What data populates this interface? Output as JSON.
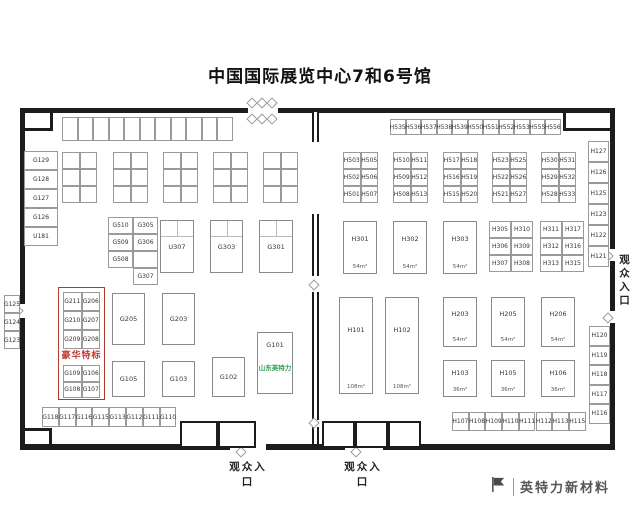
{
  "title": "中国国际展览中心7和6号馆",
  "entrances": {
    "bottom_left": "观众入口",
    "bottom_right": "观众入口",
    "right_side": "观众入口"
  },
  "watermark": {
    "brand": "英特力新材料"
  },
  "colors": {
    "wall": "#1c1c1c",
    "booth_border": "#9a9a9a",
    "accent_red": "#c0392b",
    "accent_green": "#2e9e4f"
  },
  "plan": {
    "walls": [
      [
        20,
        108,
        228,
        5
      ],
      [
        278,
        108,
        337,
        5
      ],
      [
        50,
        113,
        3,
        17
      ],
      [
        20,
        128,
        33,
        3
      ],
      [
        563,
        113,
        3,
        17
      ],
      [
        563,
        128,
        52,
        3
      ],
      [
        20,
        108,
        5,
        196
      ],
      [
        20,
        318,
        5,
        131
      ],
      [
        25,
        428,
        26,
        3
      ],
      [
        49,
        428,
        3,
        18
      ],
      [
        610,
        108,
        5,
        141
      ],
      [
        610,
        261,
        5,
        50
      ],
      [
        610,
        323,
        5,
        126
      ],
      [
        20,
        444,
        210,
        6
      ],
      [
        266,
        444,
        79,
        6
      ],
      [
        383,
        444,
        232,
        6
      ]
    ],
    "wall2": [
      [
        312,
        112,
        7,
        30
      ],
      [
        312,
        214,
        7,
        62
      ],
      [
        312,
        292,
        7,
        128
      ],
      [
        312,
        427,
        7,
        17
      ]
    ],
    "doors": [
      [
        248,
        99
      ],
      [
        258,
        99
      ],
      [
        268,
        99
      ],
      [
        248,
        115
      ],
      [
        258,
        115
      ],
      [
        268,
        115
      ],
      [
        14,
        307
      ],
      [
        604,
        252
      ],
      [
        604,
        314
      ],
      [
        310,
        281
      ],
      [
        310,
        419
      ],
      [
        237,
        448
      ],
      [
        352,
        448
      ]
    ],
    "bottom_rooms": [
      {
        "x": 180,
        "y": 421,
        "w": 76,
        "h": 27,
        "cells": 2
      },
      {
        "x": 322,
        "y": 421,
        "w": 99,
        "h": 27,
        "cells": 3
      }
    ],
    "strips": [
      {
        "name": "g-top-strip",
        "x": 62,
        "y": 117,
        "dir": "h",
        "cellW": 15.5,
        "cellH": 24,
        "labels": [
          "",
          "",
          "",
          "",
          "",
          "",
          "",
          "",
          "",
          "",
          ""
        ]
      },
      {
        "name": "h-top-strip",
        "x": 390,
        "y": 119,
        "dir": "h",
        "cellW": 15.5,
        "cellH": 16,
        "labels": [
          "H535",
          "H536",
          "H537",
          "H538",
          "H539",
          "H550",
          "H551",
          "H552",
          "H553",
          "H555",
          "H556"
        ]
      },
      {
        "name": "g-bottom-strip",
        "x": 42,
        "y": 407,
        "dir": "h",
        "cellW": 16.8,
        "cellH": 20,
        "labels": [
          "G118",
          "G117",
          "G116",
          "G115",
          "G113",
          "G112",
          "G111",
          "G110"
        ]
      },
      {
        "name": "h-bottom-strip",
        "x": 452,
        "y": 412,
        "dir": "h",
        "cellW": 16.7,
        "cellH": 19,
        "labels": [
          "H107",
          "H108",
          "H109",
          "H110",
          "H111",
          "H112",
          "H113",
          "H115"
        ]
      },
      {
        "name": "left-col-top",
        "x": 24,
        "y": 151,
        "dir": "v",
        "cellW": 34,
        "cellH": 19,
        "labels": [
          "G129",
          "G128",
          "G127",
          "G126",
          "U181"
        ]
      },
      {
        "name": "left-col-mid",
        "x": 4,
        "y": 295,
        "dir": "v",
        "cellW": 16,
        "cellH": 18,
        "labels": [
          "G125",
          "G124",
          "G123"
        ]
      },
      {
        "name": "right-col-top",
        "x": 588,
        "y": 141,
        "dir": "v",
        "cellW": 21,
        "cellH": 21,
        "labels": [
          "H127",
          "H126",
          "H125",
          "H123",
          "H122",
          "H121"
        ]
      },
      {
        "name": "right-col-bottom",
        "x": 589,
        "y": 326,
        "dir": "v",
        "cellW": 21,
        "cellH": 19.5,
        "labels": [
          "H120",
          "H119",
          "H118",
          "H117",
          "H116"
        ]
      }
    ],
    "grids": [
      {
        "name": "g-empty-1",
        "x": 62,
        "y": 152,
        "cellW": 17.5,
        "cellH": 17,
        "rows": [
          [
            "",
            ""
          ],
          [
            "",
            ""
          ],
          [
            "",
            ""
          ]
        ]
      },
      {
        "name": "g-empty-2",
        "x": 113,
        "y": 152,
        "cellW": 17.5,
        "cellH": 17,
        "rows": [
          [
            "",
            ""
          ],
          [
            "",
            ""
          ],
          [
            "",
            ""
          ]
        ]
      },
      {
        "name": "g-empty-3",
        "x": 163,
        "y": 152,
        "cellW": 17.5,
        "cellH": 17,
        "rows": [
          [
            "",
            ""
          ],
          [
            "",
            ""
          ],
          [
            "",
            ""
          ]
        ]
      },
      {
        "name": "g-empty-4",
        "x": 213,
        "y": 152,
        "cellW": 17.5,
        "cellH": 17,
        "rows": [
          [
            "",
            ""
          ],
          [
            "",
            ""
          ],
          [
            "",
            ""
          ]
        ]
      },
      {
        "name": "g-empty-5",
        "x": 263,
        "y": 152,
        "cellW": 17.5,
        "cellH": 17,
        "rows": [
          [
            "",
            ""
          ],
          [
            "",
            ""
          ],
          [
            "",
            ""
          ]
        ]
      },
      {
        "name": "g510-block",
        "x": 108,
        "y": 217,
        "cellW": 25,
        "cellH": 17,
        "rows": [
          [
            "G510",
            "G305"
          ],
          [
            "G509",
            "G306"
          ],
          [
            "G508",
            ""
          ],
          [
            null,
            "G307"
          ]
        ]
      },
      {
        "name": "red-grid-1",
        "x": 63,
        "y": 292,
        "cellW": 18.5,
        "cellH": 19,
        "rows": [
          [
            "G211",
            "G206"
          ],
          [
            "G210",
            "G207"
          ],
          [
            "G209",
            "G208"
          ]
        ]
      },
      {
        "name": "red-grid-2",
        "x": 63,
        "y": 365,
        "cellW": 18.5,
        "cellH": 16.5,
        "rows": [
          [
            "G109",
            "G106"
          ],
          [
            "G108",
            "G107"
          ]
        ]
      },
      {
        "name": "h503-block",
        "x": 343,
        "y": 152,
        "cellW": 17.5,
        "cellH": 17,
        "rows": [
          [
            "H503",
            "H505"
          ],
          [
            "H502",
            "H506"
          ],
          [
            "H501",
            "H507"
          ]
        ]
      },
      {
        "name": "h510-block",
        "x": 393,
        "y": 152,
        "cellW": 17.5,
        "cellH": 17,
        "rows": [
          [
            "H510",
            "H511"
          ],
          [
            "H509",
            "H512"
          ],
          [
            "H508",
            "H513"
          ]
        ]
      },
      {
        "name": "h517-block",
        "x": 443,
        "y": 152,
        "cellW": 17.5,
        "cellH": 17,
        "rows": [
          [
            "H517",
            "H518"
          ],
          [
            "H516",
            "H519"
          ],
          [
            "H515",
            "H520"
          ]
        ]
      },
      {
        "name": "h523-block",
        "x": 492,
        "y": 152,
        "cellW": 17.5,
        "cellH": 17,
        "rows": [
          [
            "H523",
            "H525"
          ],
          [
            "H522",
            "H526"
          ],
          [
            "H521",
            "H527"
          ]
        ]
      },
      {
        "name": "h530-block",
        "x": 541,
        "y": 152,
        "cellW": 17.5,
        "cellH": 17,
        "rows": [
          [
            "H530",
            "H531"
          ],
          [
            "H529",
            "H532"
          ],
          [
            "H528",
            "H533"
          ]
        ]
      },
      {
        "name": "h305-block",
        "x": 489,
        "y": 221,
        "cellW": 22,
        "cellH": 17,
        "rows": [
          [
            "H305",
            "H310"
          ],
          [
            "H306",
            "H309"
          ],
          [
            "H307",
            "H308"
          ]
        ]
      },
      {
        "name": "h311-block",
        "x": 540,
        "y": 221,
        "cellW": 22,
        "cellH": 17,
        "rows": [
          [
            "H311",
            "H317"
          ],
          [
            "H312",
            "H316"
          ],
          [
            "H313",
            "H315"
          ]
        ]
      }
    ],
    "rooms": [
      {
        "label": "U307",
        "x": 160,
        "y": 220,
        "w": 34,
        "h": 53,
        "div": true
      },
      {
        "label": "G303",
        "x": 210,
        "y": 220,
        "w": 33,
        "h": 53,
        "div": true
      },
      {
        "label": "G301",
        "x": 259,
        "y": 220,
        "w": 34,
        "h": 53,
        "div": true
      },
      {
        "label": "G205",
        "x": 112,
        "y": 293,
        "w": 33,
        "h": 52
      },
      {
        "label": "G203",
        "x": 162,
        "y": 293,
        "w": 33,
        "h": 52
      },
      {
        "label": "G105",
        "x": 112,
        "y": 361,
        "w": 33,
        "h": 36
      },
      {
        "label": "G103",
        "x": 162,
        "y": 361,
        "w": 33,
        "h": 36
      },
      {
        "label": "G102",
        "x": 212,
        "y": 357,
        "w": 33,
        "h": 40
      },
      {
        "label": "G101",
        "x": 257,
        "y": 332,
        "w": 36,
        "h": 62,
        "sublabel": "山东英特力",
        "labelPos": "top"
      },
      {
        "label": "H301",
        "x": 343,
        "y": 221,
        "w": 34,
        "h": 53,
        "size": "54m²"
      },
      {
        "label": "H302",
        "x": 393,
        "y": 221,
        "w": 34,
        "h": 53,
        "size": "54m²"
      },
      {
        "label": "H303",
        "x": 443,
        "y": 221,
        "w": 34,
        "h": 53,
        "size": "54m²"
      },
      {
        "label": "H101",
        "x": 339,
        "y": 297,
        "w": 34,
        "h": 97,
        "size": "108m²"
      },
      {
        "label": "H102",
        "x": 385,
        "y": 297,
        "w": 34,
        "h": 97,
        "size": "108m²"
      },
      {
        "label": "H203",
        "x": 443,
        "y": 297,
        "w": 34,
        "h": 50,
        "size": "54m²"
      },
      {
        "label": "H205",
        "x": 491,
        "y": 297,
        "w": 34,
        "h": 50,
        "size": "54m²"
      },
      {
        "label": "H206",
        "x": 541,
        "y": 297,
        "w": 34,
        "h": 50,
        "size": "54m²"
      },
      {
        "label": "H103",
        "x": 443,
        "y": 360,
        "w": 34,
        "h": 37,
        "size": "36m²"
      },
      {
        "label": "H105",
        "x": 491,
        "y": 360,
        "w": 34,
        "h": 37,
        "size": "36m²"
      },
      {
        "label": "H106",
        "x": 541,
        "y": 360,
        "w": 34,
        "h": 37,
        "size": "36m²"
      }
    ],
    "frames": [
      {
        "x": 58,
        "y": 287,
        "w": 47,
        "h": 113
      }
    ],
    "red_labels": [
      {
        "text": "豪华特标",
        "x": 58,
        "y": 348,
        "w": 47
      }
    ]
  }
}
